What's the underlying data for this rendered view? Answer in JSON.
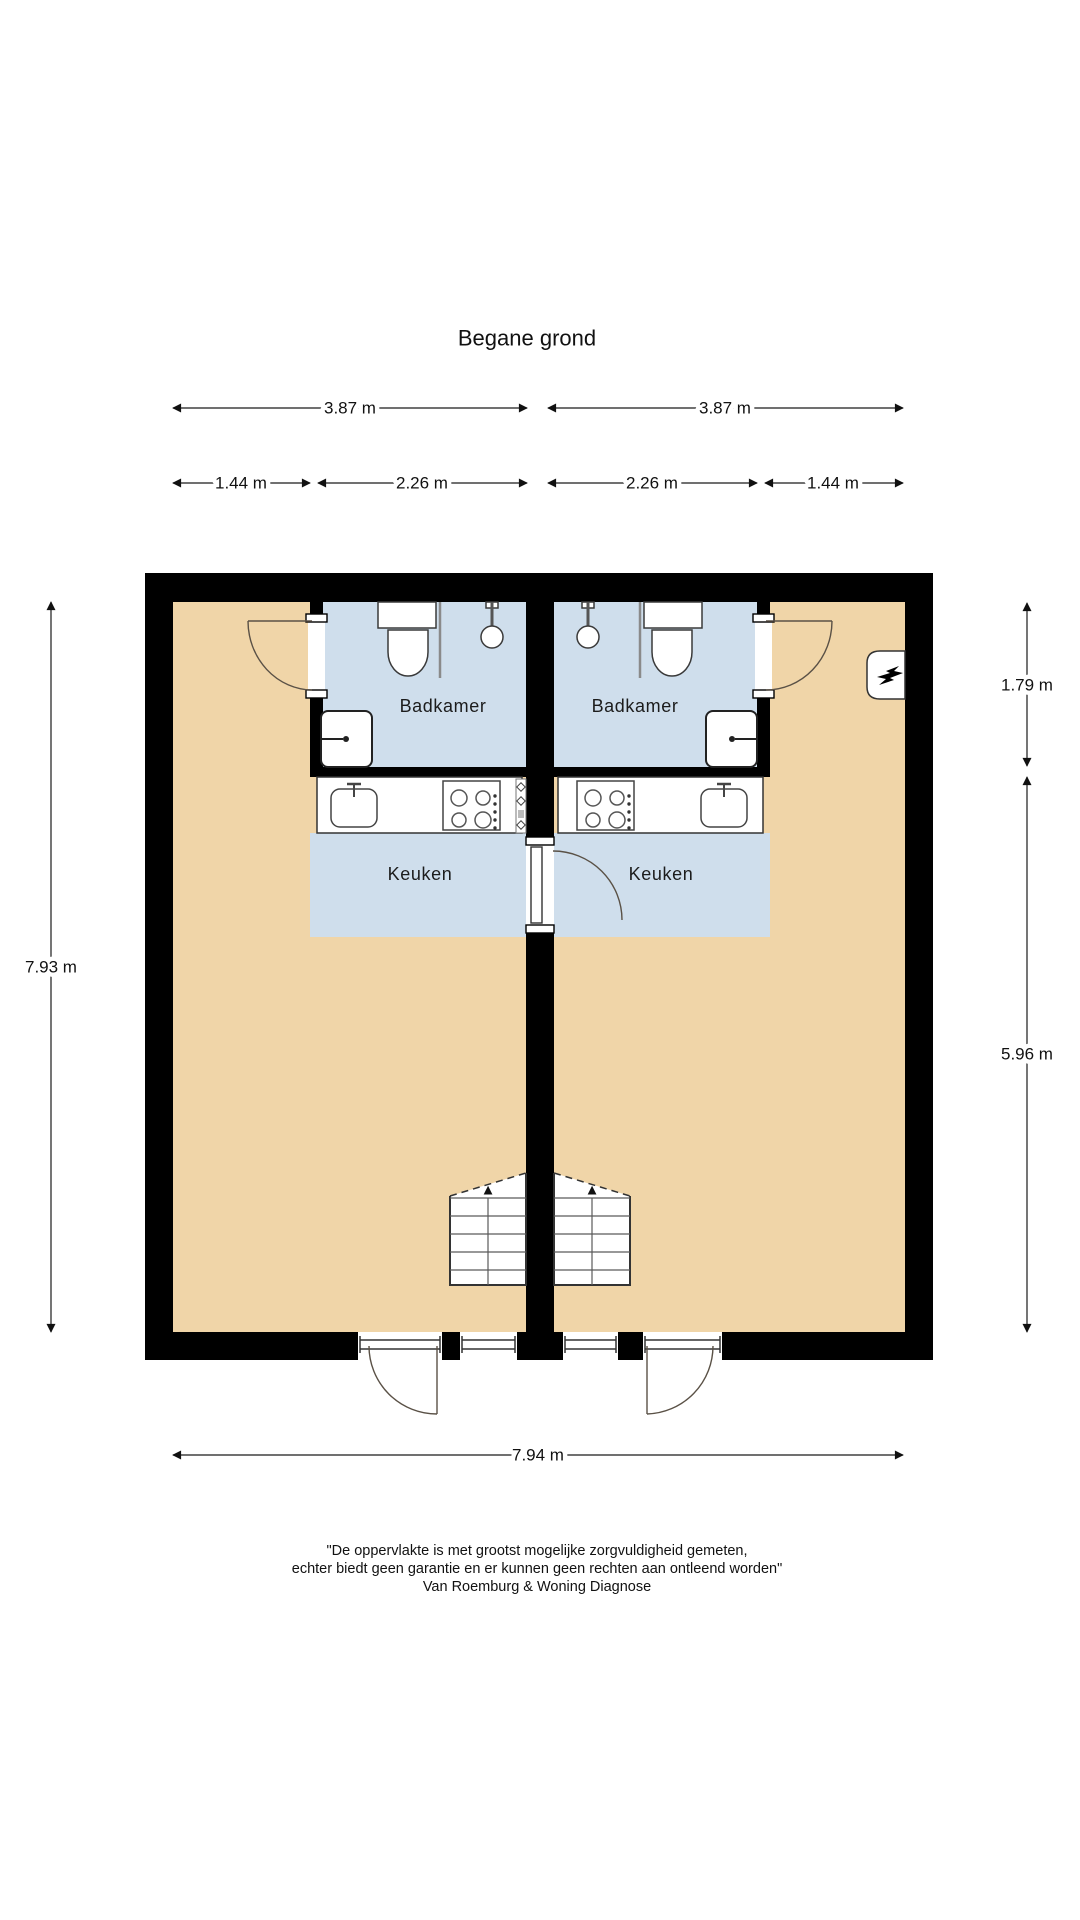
{
  "title": "Begane grond",
  "colors": {
    "floor": "#f0d5a8",
    "wet_room": "#cfdeec",
    "wall": "#000000",
    "dim_line": "#1a1a1a"
  },
  "rooms": {
    "badkamer_left": "Badkamer",
    "badkamer_right": "Badkamer",
    "keuken_left": "Keuken",
    "keuken_right": "Keuken"
  },
  "dimensions": {
    "top_width_left": "3.87 m",
    "top_width_right": "3.87 m",
    "hall_width_left": "1.44 m",
    "badkamer_width_left": "2.26 m",
    "badkamer_width_right": "2.26 m",
    "hall_width_right": "1.44 m",
    "height_left": "7.93 m",
    "badkamer_height_right": "1.79 m",
    "room_height_right": "5.96 m",
    "total_width_bottom": "7.94 m"
  },
  "icons": {
    "stairs_up_arrow": "▲"
  },
  "disclaimer": {
    "line1": "\"De oppervlakte is met grootst mogelijke zorgvuldigheid gemeten,",
    "line2": "echter biedt geen garantie en er kunnen geen rechten aan ontleend worden\"",
    "line3": "Van Roemburg & Woning Diagnose"
  }
}
